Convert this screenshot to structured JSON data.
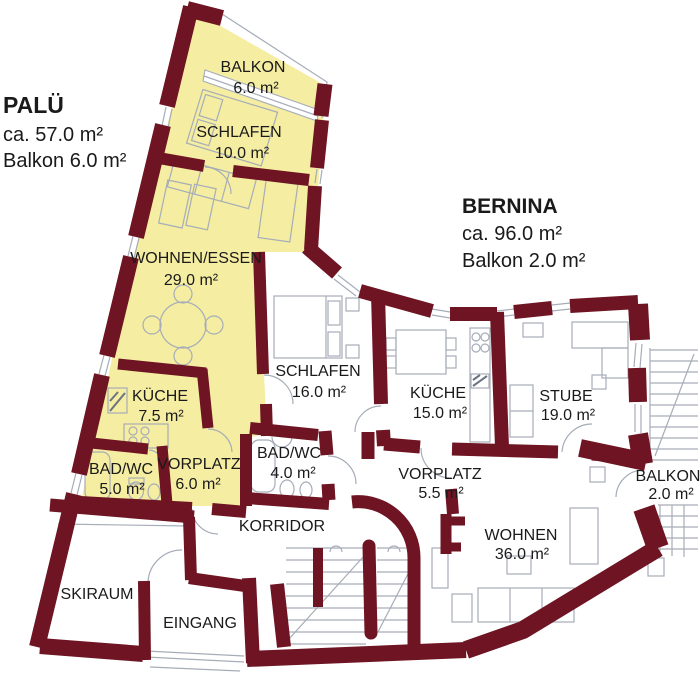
{
  "colors": {
    "wall": "#6E1422",
    "highlight": "#F5EDA1",
    "furniture_line": "#A6ADB8",
    "text": "#1A1A1A"
  },
  "legend": {
    "palue": {
      "title": "PALÜ",
      "size": "ca. 57.0 m²",
      "balcony": "Balkon 6.0 m²"
    },
    "bernina": {
      "title": "BERNINA",
      "size": "ca. 96.0 m²",
      "balcony": "Balkon 2.0 m²"
    }
  },
  "rooms": {
    "balkon_palue": {
      "name": "BALKON",
      "area": "6.0 m²"
    },
    "schlafen_palue": {
      "name": "SCHLAFEN",
      "area": "10.0 m²"
    },
    "wohnen_essen": {
      "name": "WOHNEN/ESSEN",
      "area": "29.0 m²"
    },
    "kueche_palue": {
      "name": "KÜCHE",
      "area": "7.5 m²"
    },
    "bad_palue": {
      "name": "BAD/WC",
      "area": "5.0 m²"
    },
    "vorplatz_palue": {
      "name": "VORPLATZ",
      "area": "6.0 m²"
    },
    "schlafen_bernina": {
      "name": "SCHLAFEN",
      "area": "16.0 m²"
    },
    "bad_bernina": {
      "name": "BAD/WC",
      "area": "4.0 m²"
    },
    "kueche_bernina": {
      "name": "KÜCHE",
      "area": "15.0 m²"
    },
    "stube": {
      "name": "STUBE",
      "area": "19.0 m²"
    },
    "vorplatz_bernina": {
      "name": "VORPLATZ",
      "area": "5.5 m²"
    },
    "wohnen_bernina": {
      "name": "WOHNEN",
      "area": "36.0 m²"
    },
    "balkon_bernina": {
      "name": "BALKON",
      "area": "2.0 m²"
    },
    "korridor": {
      "name": "KORRIDOR"
    },
    "skiraum": {
      "name": "SKIRAUM"
    },
    "eingang": {
      "name": "EINGANG"
    }
  }
}
